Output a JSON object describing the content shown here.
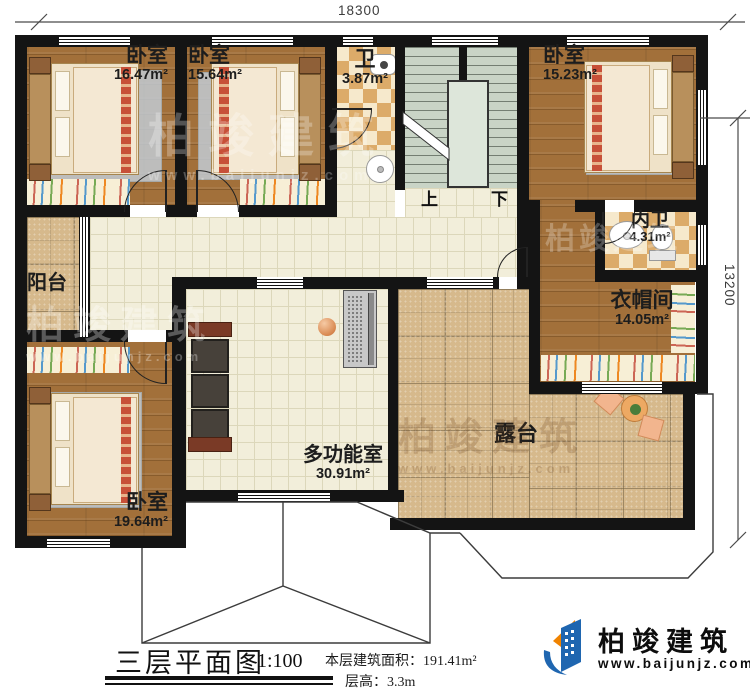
{
  "dimensions": {
    "top": "18300",
    "right": "13200"
  },
  "rooms": [
    {
      "name": "卧室",
      "area": "16.47m²"
    },
    {
      "name": "卧室",
      "area": "15.64m²"
    },
    {
      "name": "卫",
      "area": "3.87m²"
    },
    {
      "name": "卧室",
      "area": "15.23m²"
    },
    {
      "name": "内卫",
      "area": "4.31m²"
    },
    {
      "name": "衣帽间",
      "area": "14.05m²"
    },
    {
      "name": "阳台"
    },
    {
      "name": "卧室",
      "area": "19.64m²"
    },
    {
      "name": "多功能室",
      "area": "30.91m²"
    },
    {
      "name": "露台"
    }
  ],
  "stairs": {
    "up": "上",
    "down": "下"
  },
  "title": {
    "text": "三层平面图",
    "scale": "1:100"
  },
  "info": {
    "area_label": "本层建筑面积：",
    "area_value": "191.41m²",
    "floor_height_label": "层高：",
    "floor_height_value": "3.3m"
  },
  "logo": {
    "name": "柏竣建筑",
    "url": "www.baijunjz.com"
  },
  "watermark": {
    "name": "柏竣建筑",
    "url": "www.baijunjz.com"
  },
  "colors": {
    "logo_blue": "#1f66b0",
    "logo_orange": "#f08300",
    "wall": "#141414"
  }
}
